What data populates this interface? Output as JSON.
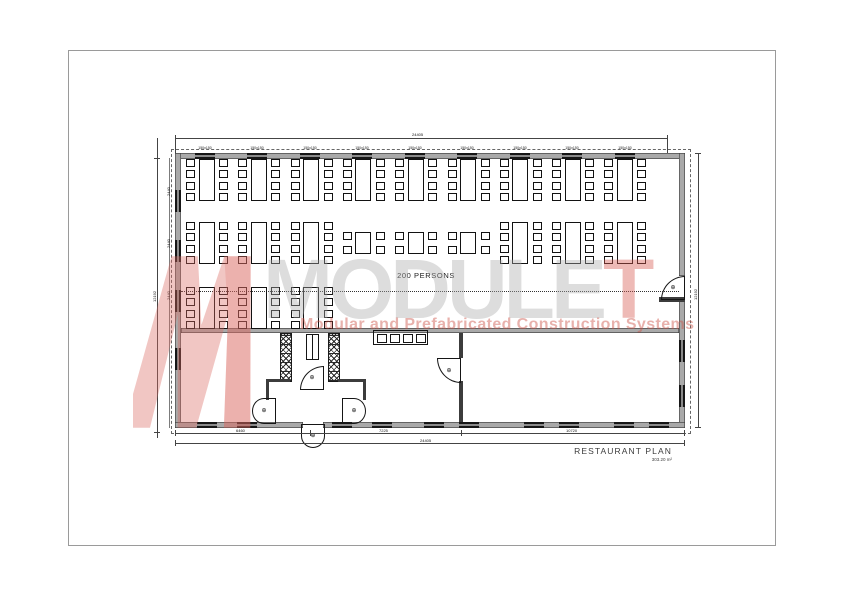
{
  "drawing": {
    "capacity_label": "200 PERSONS",
    "title": "RESTAURANT PLAN",
    "area_label": "303.20 m²"
  },
  "watermark": {
    "brand_main": "MODULE",
    "brand_accent": "T",
    "tagline": "Modular and Prefabricated Construction Systems",
    "accent_color": "#d65a50",
    "gray_color": "#aaaaaa"
  },
  "dimensions": {
    "top_total": "24405",
    "bottom_total": "24405",
    "bottom_segments": [
      "6460",
      "7225",
      "10720"
    ],
    "left_total": "12192",
    "left_segments": [
      "2440",
      "2440",
      "2440"
    ],
    "right_total": "12192"
  },
  "windows": {
    "size_label": "150x150",
    "top_x": [
      195,
      247,
      300,
      352,
      405,
      457,
      510,
      562,
      615
    ],
    "bottom_x": [
      197,
      237,
      332,
      372,
      424,
      459,
      524,
      559,
      614,
      649
    ],
    "left_y": [
      190,
      240,
      290,
      348
    ],
    "right_y": [
      340,
      385
    ]
  },
  "furniture": {
    "col_start_x": 185,
    "col_step": 52.3,
    "unit_w": 44,
    "seat8_h": 42,
    "seat4_h": 22,
    "rows": [
      {
        "y": 159,
        "units": [
          "8",
          "8",
          "8",
          "8",
          "8",
          "8",
          "8",
          "8",
          "8"
        ]
      },
      {
        "y": 222,
        "units": [
          "8",
          "8",
          "8",
          "4",
          "4",
          "4",
          "8",
          "8",
          "8"
        ]
      },
      {
        "y": 287,
        "units": [
          "8",
          "8",
          "8"
        ]
      }
    ]
  }
}
